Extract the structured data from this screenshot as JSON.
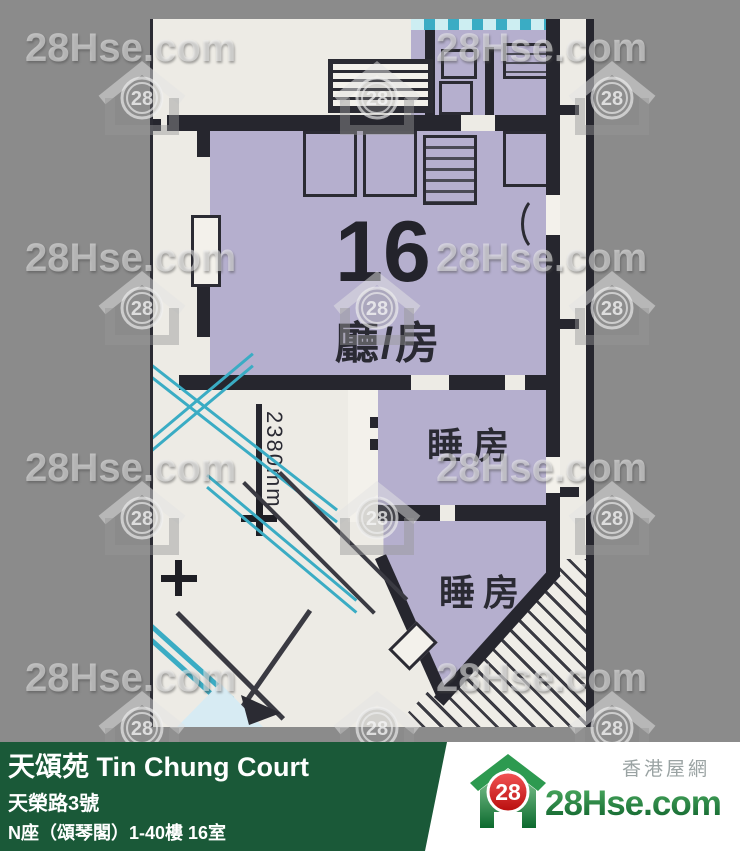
{
  "watermark": {
    "text": "28Hse.com",
    "badge": "28"
  },
  "floor_plan": {
    "unit_number": "16",
    "living_room_label": "廳/房",
    "bedroom1_label": "睡房",
    "bedroom2_label": "睡房",
    "dimension_label": "2380mm"
  },
  "info_bar": {
    "estate_name": "天頌苑 Tin Chung Court",
    "address": "天榮路3號",
    "block_unit": "N座（頌琴閣）1-40樓 16室",
    "area": "636-645 sqf(實用面積 Saleable Area)"
  },
  "logo": {
    "tagline": "香港屋網",
    "site_name": "28Hse.com",
    "badge": "28"
  },
  "colors": {
    "bar_green": "#1a5938",
    "unit_fill": "#b5afce",
    "wall": "#26262e",
    "glass_teal": "#3aacc4",
    "brand_green": "#1d8f42",
    "badge_red": "#d81616"
  }
}
